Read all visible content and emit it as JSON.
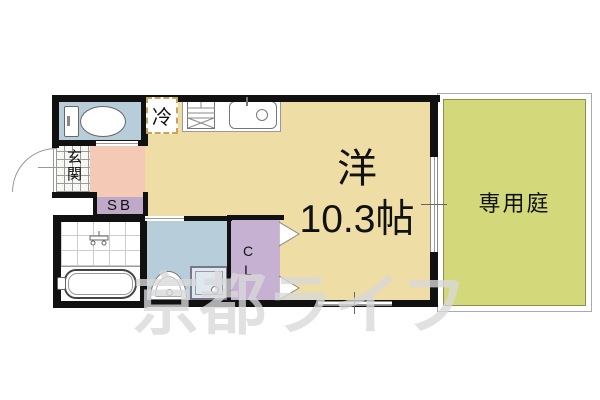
{
  "floorplan": {
    "main_room": {
      "type_label": "洋",
      "size_label": "10.3帖"
    },
    "garden": {
      "label": "専用庭"
    },
    "entrance": {
      "label": "玄関"
    },
    "shoe_box": {
      "label": "SB"
    },
    "closet": {
      "label": "CL"
    },
    "refrigerator": {
      "label": "冷"
    },
    "watermark": {
      "text": "京都ライフ"
    },
    "colors": {
      "main_room_tan": "#eedda4",
      "garden_green": "#d3d97a",
      "wet_area_blue": "#b8cdda",
      "hall_pink": "#f4c9b6",
      "shoe_box_purple": "#bfa9c8",
      "closet_purple": "#c6b1d2",
      "wall_black": "#111111",
      "refrigerator_dash": "#c9a45c"
    }
  }
}
